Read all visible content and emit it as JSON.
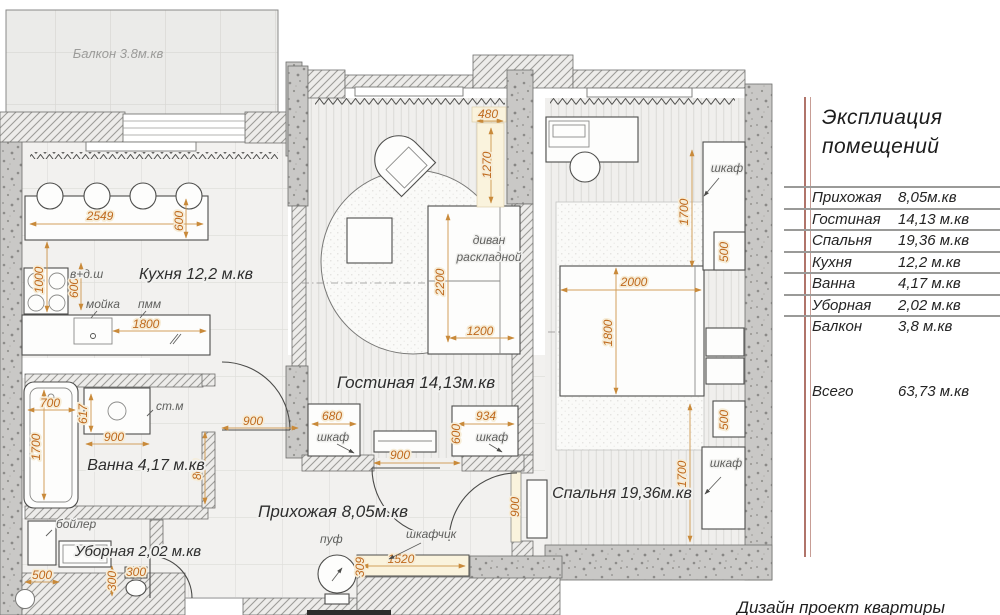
{
  "plan": {
    "rooms": {
      "balcony": "Балкон 3.8м.кв",
      "kitchen": "Кухня 12,2 м.кв",
      "living": "Гостиная 14,13м.кв",
      "bedroom": "Спальня 19,36м.кв",
      "bath": "Ванна 4,17 м.кв",
      "wc": "Уборная 2,02 м.кв",
      "hall": "Прихожая 8,05м.кв"
    },
    "furniture": {
      "sink": "мойка",
      "dishwasher": "пмм",
      "hood": "в+д.ш",
      "washer": "ст.м",
      "boiler": "бойлер",
      "sofa_l1": "диван",
      "sofa_l2": "раскладной",
      "wardrobe": "шкаф",
      "pouf": "пуф",
      "cabinet": "шкафчик"
    },
    "dims": {
      "v2549": "2549",
      "v600": "600",
      "v1000": "1000",
      "v1800": "1800",
      "v480": "480",
      "v1270": "1270",
      "v2200": "2200",
      "v1200": "1200",
      "v680": "680",
      "v934": "934",
      "v900": "900",
      "v700": "700",
      "v1700": "1700",
      "v617": "617",
      "v800": "800",
      "v500": "500",
      "v300": "300",
      "v1520": "1520",
      "v309": "309",
      "v2000": "2000"
    }
  },
  "legend": {
    "title_line1": "Эксплиация",
    "title_line2": "помещений",
    "rows": [
      {
        "name": "Прихожая",
        "area": "8,05м.кв"
      },
      {
        "name": "Гостиная",
        "area": "14,13 м.кв"
      },
      {
        "name": "Спальня",
        "area": "19,36 м.кв"
      },
      {
        "name": "Кухня",
        "area": "12,2 м.кв"
      },
      {
        "name": "Ванна",
        "area": "4,17 м.кв"
      },
      {
        "name": "Уборная",
        "area": "2,02 м.кв"
      },
      {
        "name": "Балкон",
        "area": "3,8 м.кв"
      }
    ],
    "total_label": "Всего",
    "total_area": "63,73 м.кв"
  },
  "footer": {
    "caption": "Дизайн проект квартиры"
  },
  "colors": {
    "dim_text": "#bf6a1e",
    "dim_line": "#d2a05c",
    "legend_rule": "#9a9a98",
    "legend_accent": "#b0746a",
    "wall_hatch": "#9d9c99",
    "concrete": "#c9c8c6",
    "highlight": "#faf3dd"
  }
}
